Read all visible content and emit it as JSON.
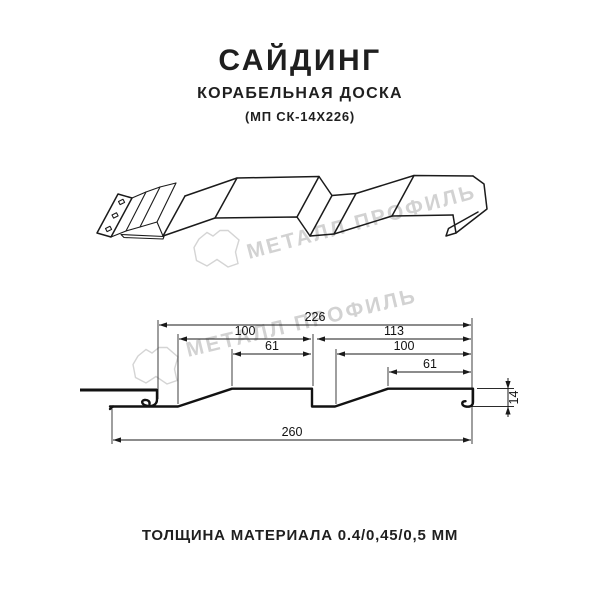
{
  "header": {
    "title": "САЙДИНГ",
    "subtitle": "КОРАБЕЛЬНАЯ ДОСКА",
    "model": "(МП СК-14Х226)"
  },
  "footer": {
    "thickness": "ТОЛЩИНА МАТЕРИАЛА 0.4/0,45/0,5 ММ"
  },
  "watermark": {
    "logo_icon": "metall-profil-logo",
    "text": "МЕТАЛЛ ПРОФИЛЬ",
    "color": "#d2d2d2"
  },
  "colors": {
    "line": "#1a1a1a",
    "background": "#ffffff"
  },
  "dimensions_mm": {
    "top_width": "226",
    "panel1_width": "100",
    "crest1_width": "61",
    "panel2_width": "113",
    "panel2_inner_width": "100",
    "crest2_width": "61",
    "total_width": "260",
    "profile_height": "14"
  }
}
